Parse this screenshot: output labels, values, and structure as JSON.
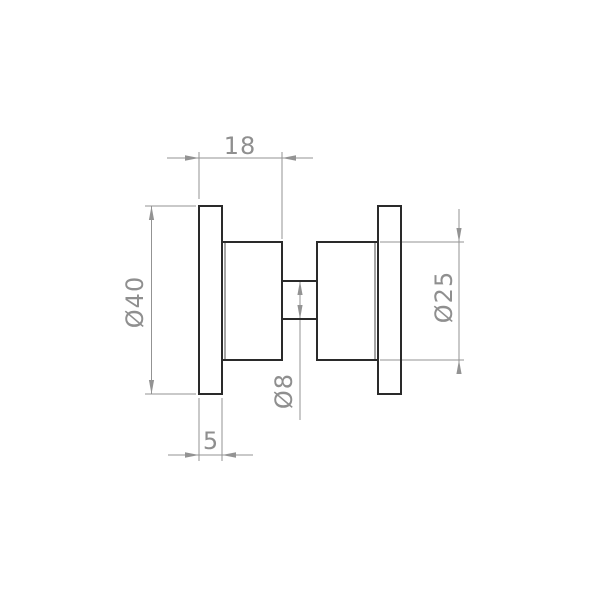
{
  "colors": {
    "background": "#ffffff",
    "object_line": "#2a2a2a",
    "tangent_line": "#4d4d4d",
    "dimension_line": "#939393",
    "dimension_text": "#8f8f8f"
  },
  "dimensions": {
    "knob_depth": {
      "label": "18"
    },
    "flange_thickness": {
      "label": "5"
    },
    "flange_diameter": {
      "label": "Ø40"
    },
    "knob_diameter": {
      "label": "Ø25"
    },
    "neck_diameter": {
      "label": "Ø8"
    }
  }
}
